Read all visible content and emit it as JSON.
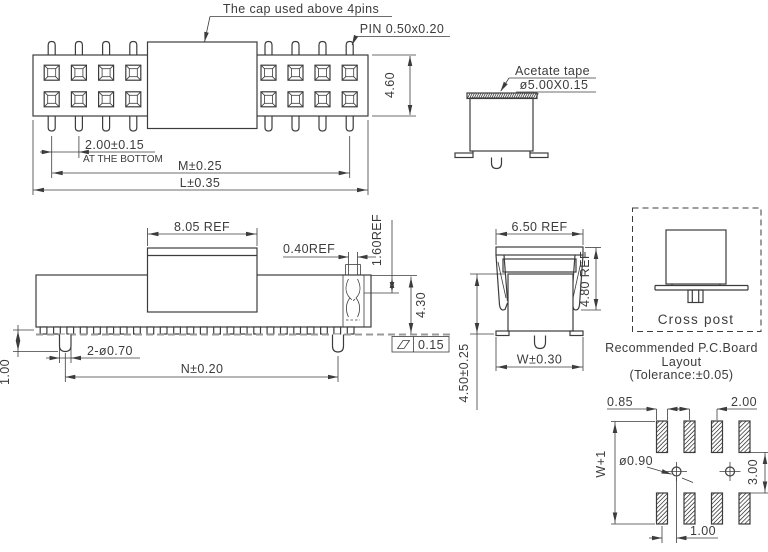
{
  "top_view": {
    "cap_note": "The cap used above 4pins",
    "pin_note": "PIN 0.50x0.20",
    "dim_height": "4.60",
    "dim_pitch": "2.00±0.15",
    "pitch_note": "AT THE BOTTOM",
    "dim_m": "M±0.25",
    "dim_l": "L±0.35"
  },
  "tape_view": {
    "note_line1": "Acetate tape",
    "note_line2": "ø5.00X0.15"
  },
  "front_view": {
    "dim_cap_width": "8.05 REF",
    "dim_slot_width": "0.40REF",
    "dim_slot_depth": "1.60REF",
    "dim_height": "4.30",
    "flatness": "0.15",
    "dim_holes": "2-ø0.70",
    "dim_span": "N±0.20",
    "dim_peg": "1.00"
  },
  "side_view": {
    "dim_cap_width": "6.50 REF",
    "dim_cap_height": "4.80 REF",
    "dim_width": "W±0.30",
    "dim_total_height": "4.50±0.25"
  },
  "cross_post": {
    "label": "Cross post"
  },
  "pcb_layout": {
    "title_line1": "Recommended P.C.Board",
    "title_line2": "Layout",
    "title_line3": "(Tolerance:±0.05)",
    "dim_pad_width": "0.85",
    "dim_pitch": "2.00",
    "dim_hole": "ø0.90",
    "dim_height": "W+1",
    "dim_row_gap": "3.00",
    "dim_offset": "1.00"
  },
  "colors": {
    "line": "#3c3c3c",
    "board_line": "#9a9a9a",
    "background": "#ffffff"
  }
}
